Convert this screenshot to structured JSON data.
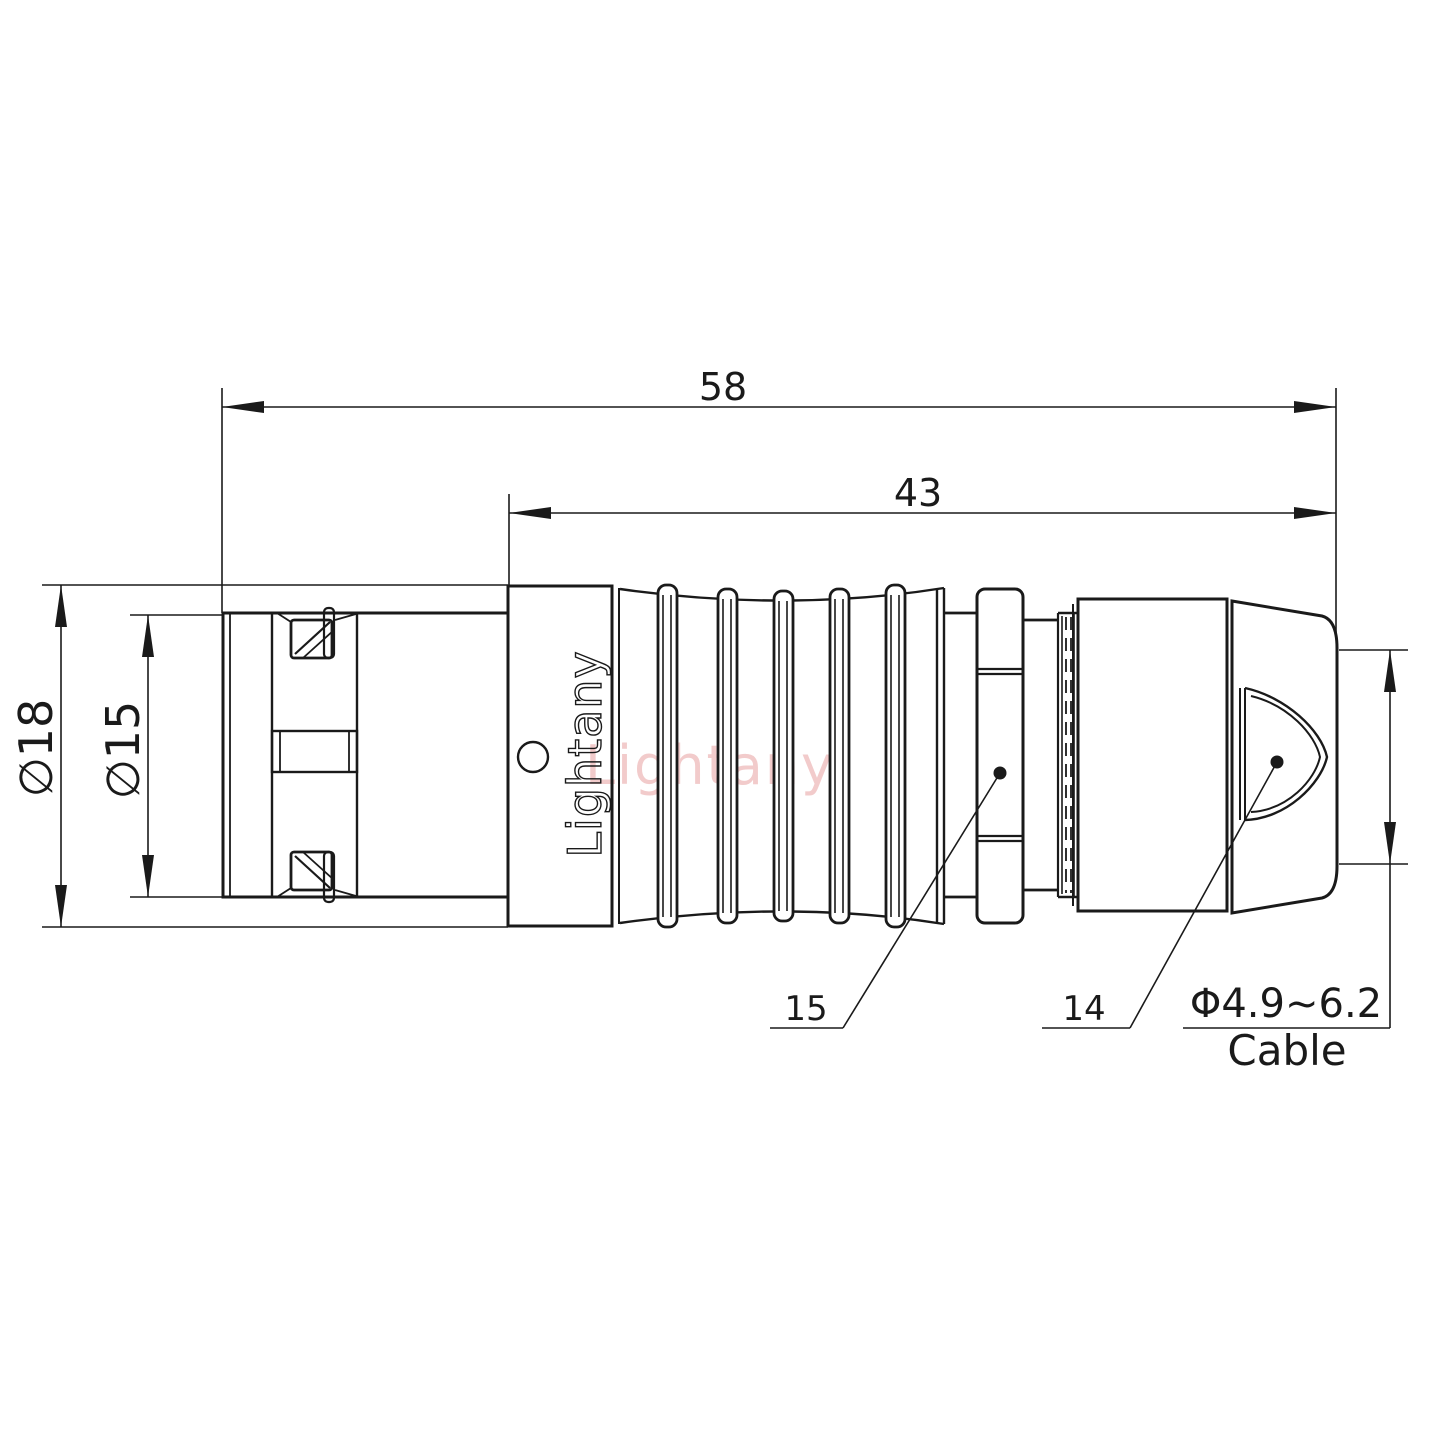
{
  "colors": {
    "line": "#1a1a1a",
    "background": "#ffffff"
  },
  "watermark": {
    "text": "Lightany",
    "color": "#f2cbcb"
  },
  "logo": {
    "text": "Lightany"
  },
  "dimensions": {
    "overall_length": "58",
    "rear_length": "43",
    "outer_diameter": "∅18",
    "front_diameter": "∅15",
    "nut_ref": "15",
    "boot_ref": "14",
    "cable_range": "Φ4.9~6.2",
    "cable_label": "Cable"
  }
}
